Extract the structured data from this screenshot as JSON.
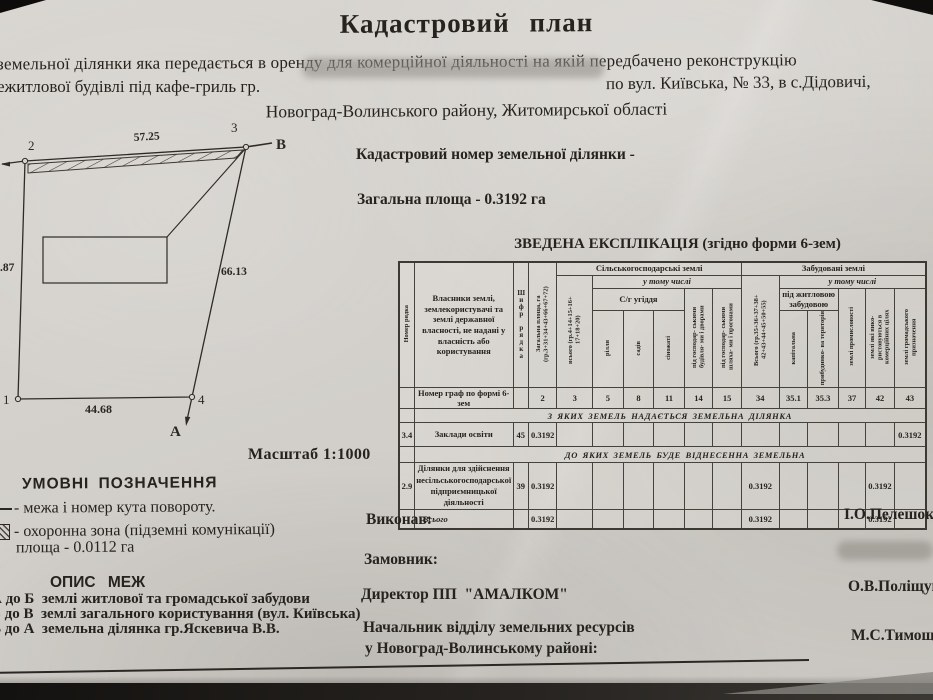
{
  "header": {
    "title": "Кадастровий  план",
    "line1": "земельної ділянки  яка передається в оренду для комерційної діяльності на якій передбачено реконструкцію",
    "line2_left": "ежитлової будівлі під кафе-гриль гр.",
    "line2_right": "по вул. Київська, № 33, в с.Дідовичі,",
    "line3": "Новоград-Волинського району, Житомирської області"
  },
  "plan": {
    "cadastral_number_label": "Кадастровий номер земельної ділянки -",
    "total_area": "Загальна площа - 0.3192 га",
    "scale": "Масштаб 1:1000"
  },
  "diagram": {
    "point1": "1",
    "point2": "2",
    "point3": "3",
    "point4": "4",
    "dir_a": "А",
    "dir_b": "В",
    "len_top": "57.25",
    "len_right": "66.13",
    "len_bottom": "44.68",
    "len_left": ".87"
  },
  "legend": {
    "heading": "УМОВНІ ПОЗНАЧЕННЯ",
    "item1": "- межа і номер кута повороту.",
    "item2": "- охоронна зона (підземні комунікації)",
    "item2_area": "площа - 0.0112 га"
  },
  "borders": {
    "heading": "ОПИС  МЕЖ",
    "items": [
      "А до Б  землі житлової та громадської забудови",
      "Б до В  землі загального користування (вул. Київська)",
      "В до А  земельна ділянка гр.Яскевича В.В."
    ]
  },
  "table": {
    "title": "ЗВЕДЕНА ЕКСПЛІКАЦІЯ (згідно форми 6-зем)",
    "head": {
      "row_number": "Номер рядка",
      "owners": "Власники землі, землекористувачі та землі державної власності, не надані у власність  або користування",
      "row_code": "Шифр рядка",
      "total_area": "Загальна площа, га (гр.3+31+34+43+66+67+72)",
      "agri": "Сільськогосподарські землі",
      "incl": "у тому числі",
      "agri_total": "всього (гр.4+14+15+16+ 17+18+20)",
      "ugiddia": "С/г угіддя",
      "rillia": "рілля",
      "sadiv": "садів",
      "sinozhati": "сіножаті",
      "gosp_bud": "під господар- ськими будівля- ми і дворами",
      "gosp_shl": "під господар- ськими шляха- ми і прогонами",
      "built": "Забудовані землі",
      "built_total": "Всього (гр.35+36+37+38+ 42+43+44+45+50+55)",
      "incl2": "у тому числі",
      "housing": "під житловою забудовою",
      "capital": "капітальна",
      "adjacent": "прибудинко- ва територія",
      "industry": "землі промисловості",
      "commercial": "землі які вико- ристовуються в комерційних цілях",
      "public": "землі громадського призначення"
    },
    "graph_row": {
      "label": "Номер граф по формі 6-зем",
      "c2": "2",
      "c3": "3",
      "c5": "5",
      "c8": "8",
      "c11": "11",
      "c14": "14",
      "c15": "15",
      "c34": "34",
      "c35_1": "35.1",
      "c35_3": "35.3",
      "c37": "37",
      "c42": "42",
      "c43": "43"
    },
    "section1": "З ЯКИХ ЗЕМЕЛЬ НАДАЄТЬСЯ ЗЕМЕЛЬНА ДІЛЯНКА",
    "row1": {
      "num": "3.4",
      "name": "Заклади освіти",
      "code": "45",
      "total": "0.3192",
      "col43": "0.3192"
    },
    "section2": "ДО ЯКИХ ЗЕМЕЛЬ БУДЕ ВІДНЕСЕННА ЗЕМЕЛЬНА",
    "row2": {
      "num": "2.9",
      "name": "Ділянки для здійснення несільськогосподарської підприємницької діяльності",
      "code": "39",
      "total": "0.3192",
      "col34": "0.3192",
      "col42": "0.3192"
    },
    "total_row": {
      "label": "Всього",
      "total": "0.3192",
      "col34": "0.3192",
      "col42": "0.3192"
    }
  },
  "signatures": {
    "executor_label": "Виконав:",
    "executor_name": "І.О.Пелешок",
    "customer_label": "Замовник:",
    "director_label": "Директор ПП  \"АМАЛКОМ\"",
    "director_name": "О.В.Поліщук",
    "chief_label1": "Начальник відділу земельних ресурсів",
    "chief_label2": "у Новоград-Волинському районі:",
    "chief_name": "М.С.Тимощук"
  }
}
